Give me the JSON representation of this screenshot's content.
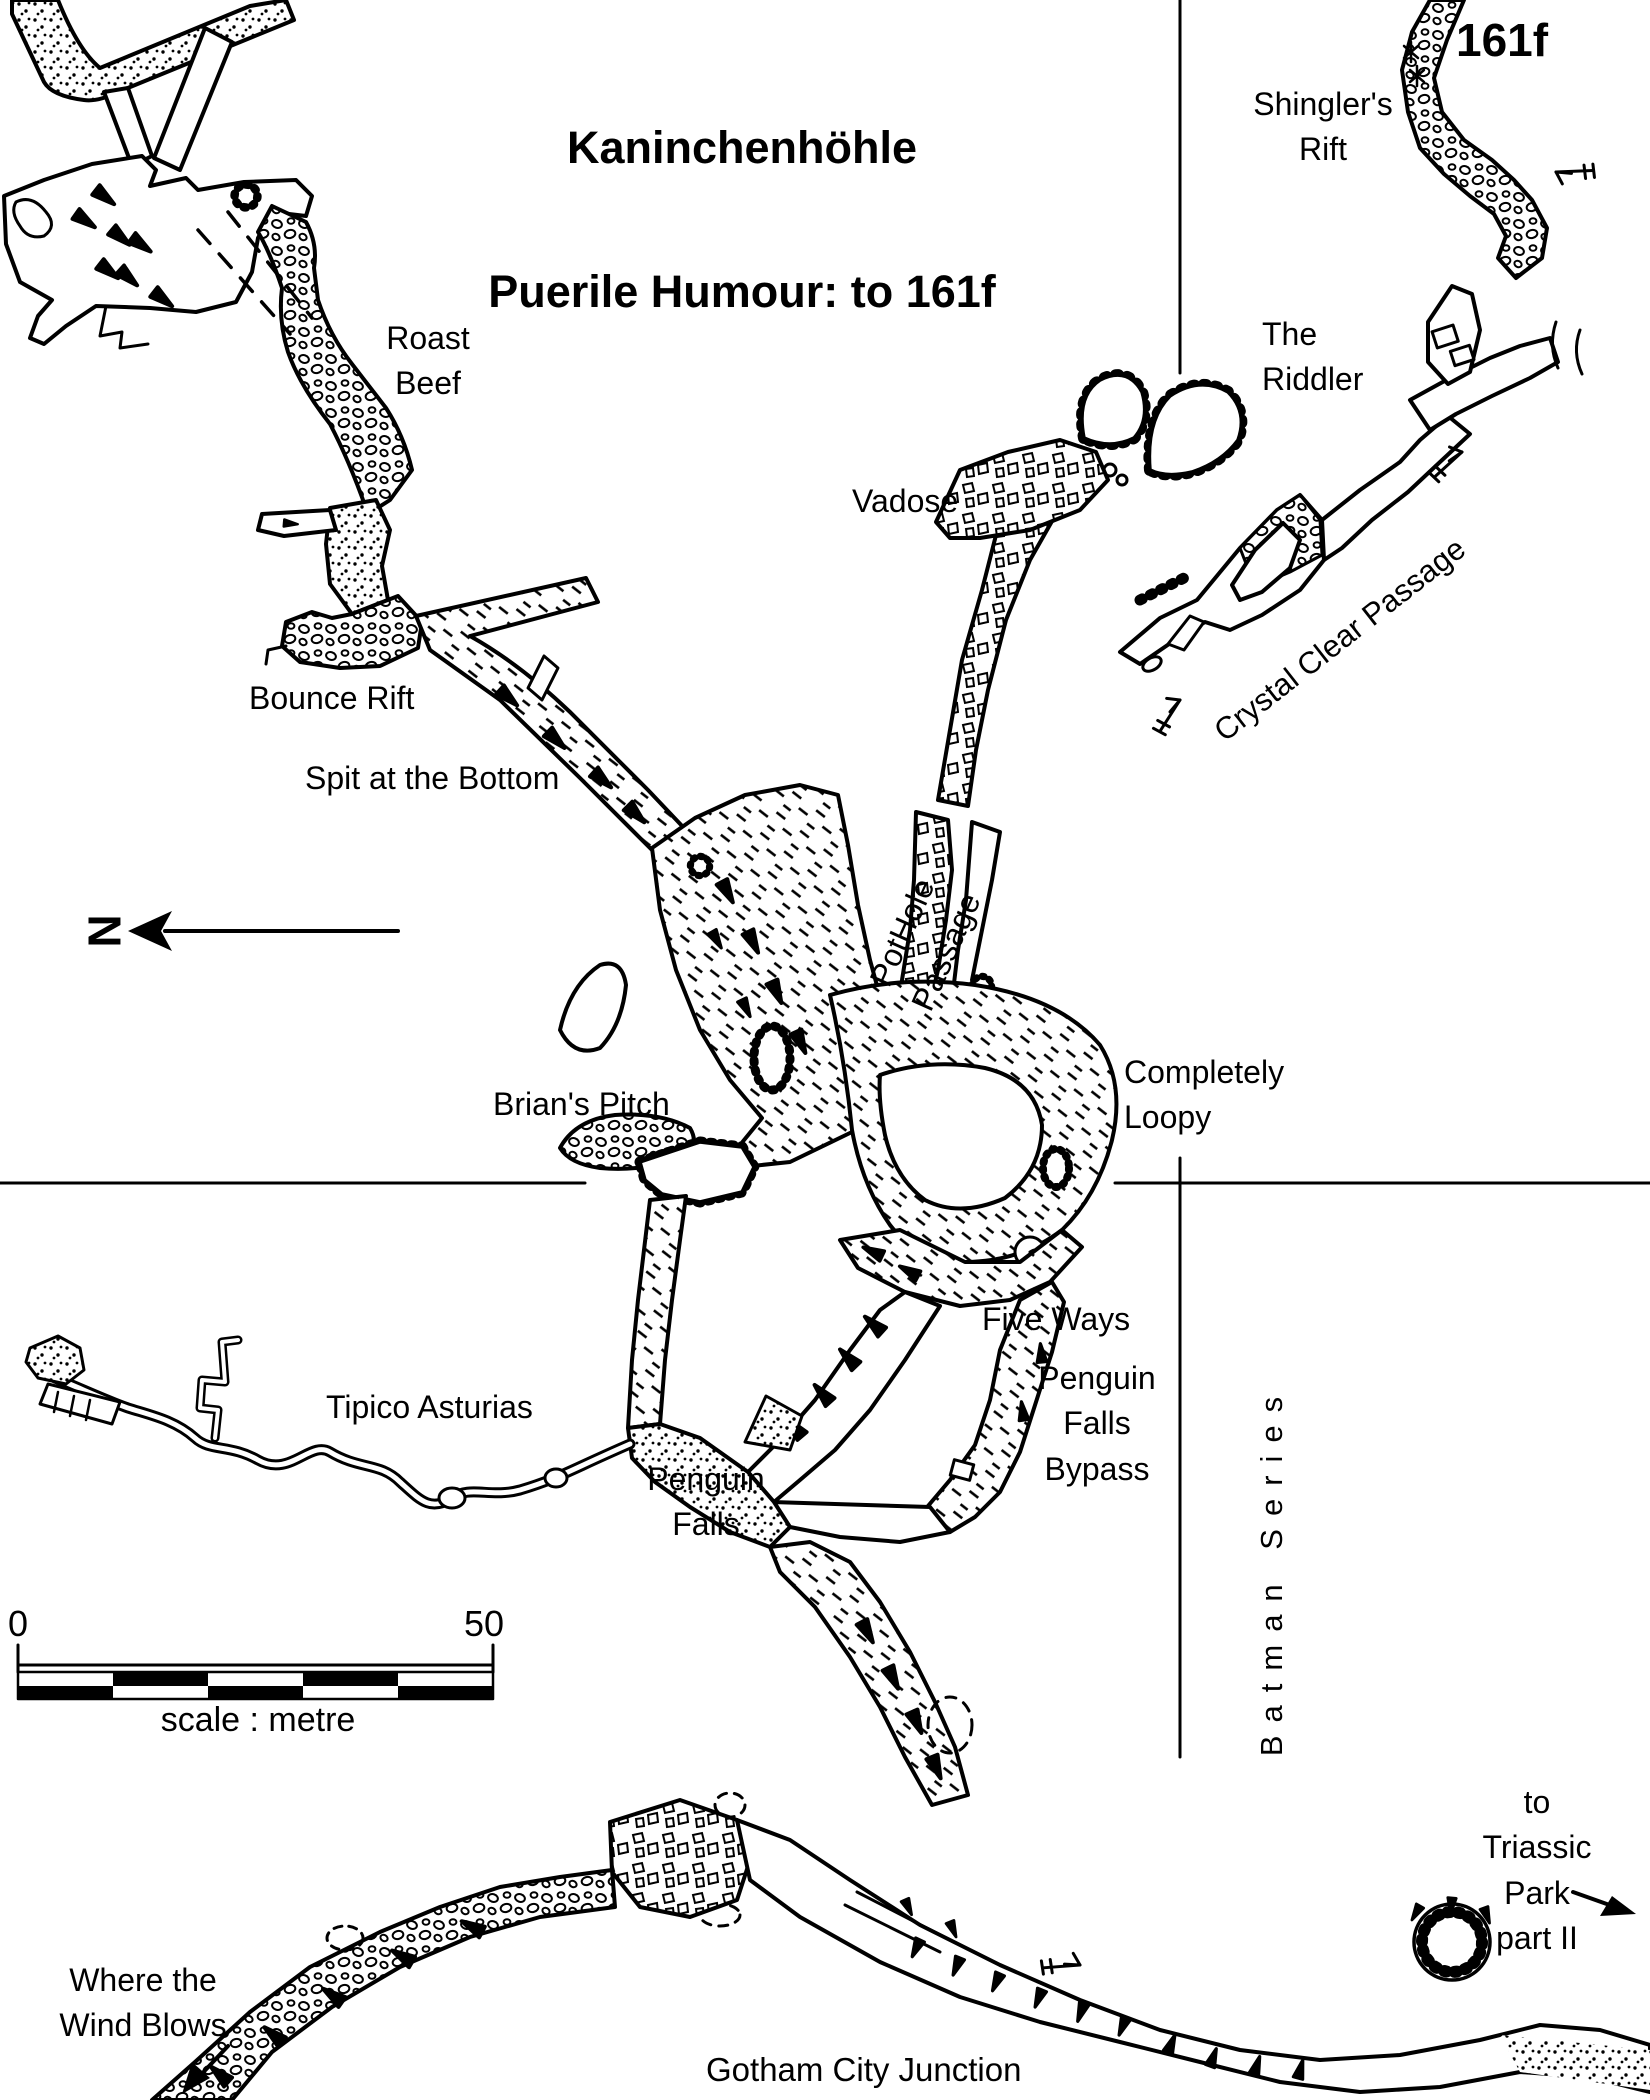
{
  "title": {
    "line1": "Kaninchenhöhle",
    "line2": "Puerile Humour: to 161f"
  },
  "corner_tag": "161f",
  "north": {
    "letter": "N"
  },
  "scale_bar": {
    "start": "0",
    "end": "50",
    "caption": "scale : metre"
  },
  "passages": {
    "shinglers_rift": "Shingler's\nRift",
    "roast_beef": "Roast\nBeef",
    "the_riddler": "The\nRiddler",
    "vadose": "Vadose",
    "crystal_clear_passage": "Crystal Clear Passage",
    "bounce_rift": "Bounce Rift",
    "spit_at_the_bottom": "Spit at the Bottom",
    "pothole_passage": "PotHole\nPassage",
    "brians_pitch": "Brian's Pitch",
    "completely_loopy": "Completely\nLoopy",
    "five_ways": "Five Ways",
    "penguin_falls_bypass": "Penguin\nFalls\nBypass",
    "tipico_asturias": "Tipico Asturias",
    "penguin_falls": "Penguin\nFalls",
    "batman_series": "Batman Series",
    "to_triassic_park": "to Triassic\nPark part II",
    "where_the_wind_blows": "Where the\nWind Blows",
    "gotham_city_junction": "Gotham City Junction"
  }
}
